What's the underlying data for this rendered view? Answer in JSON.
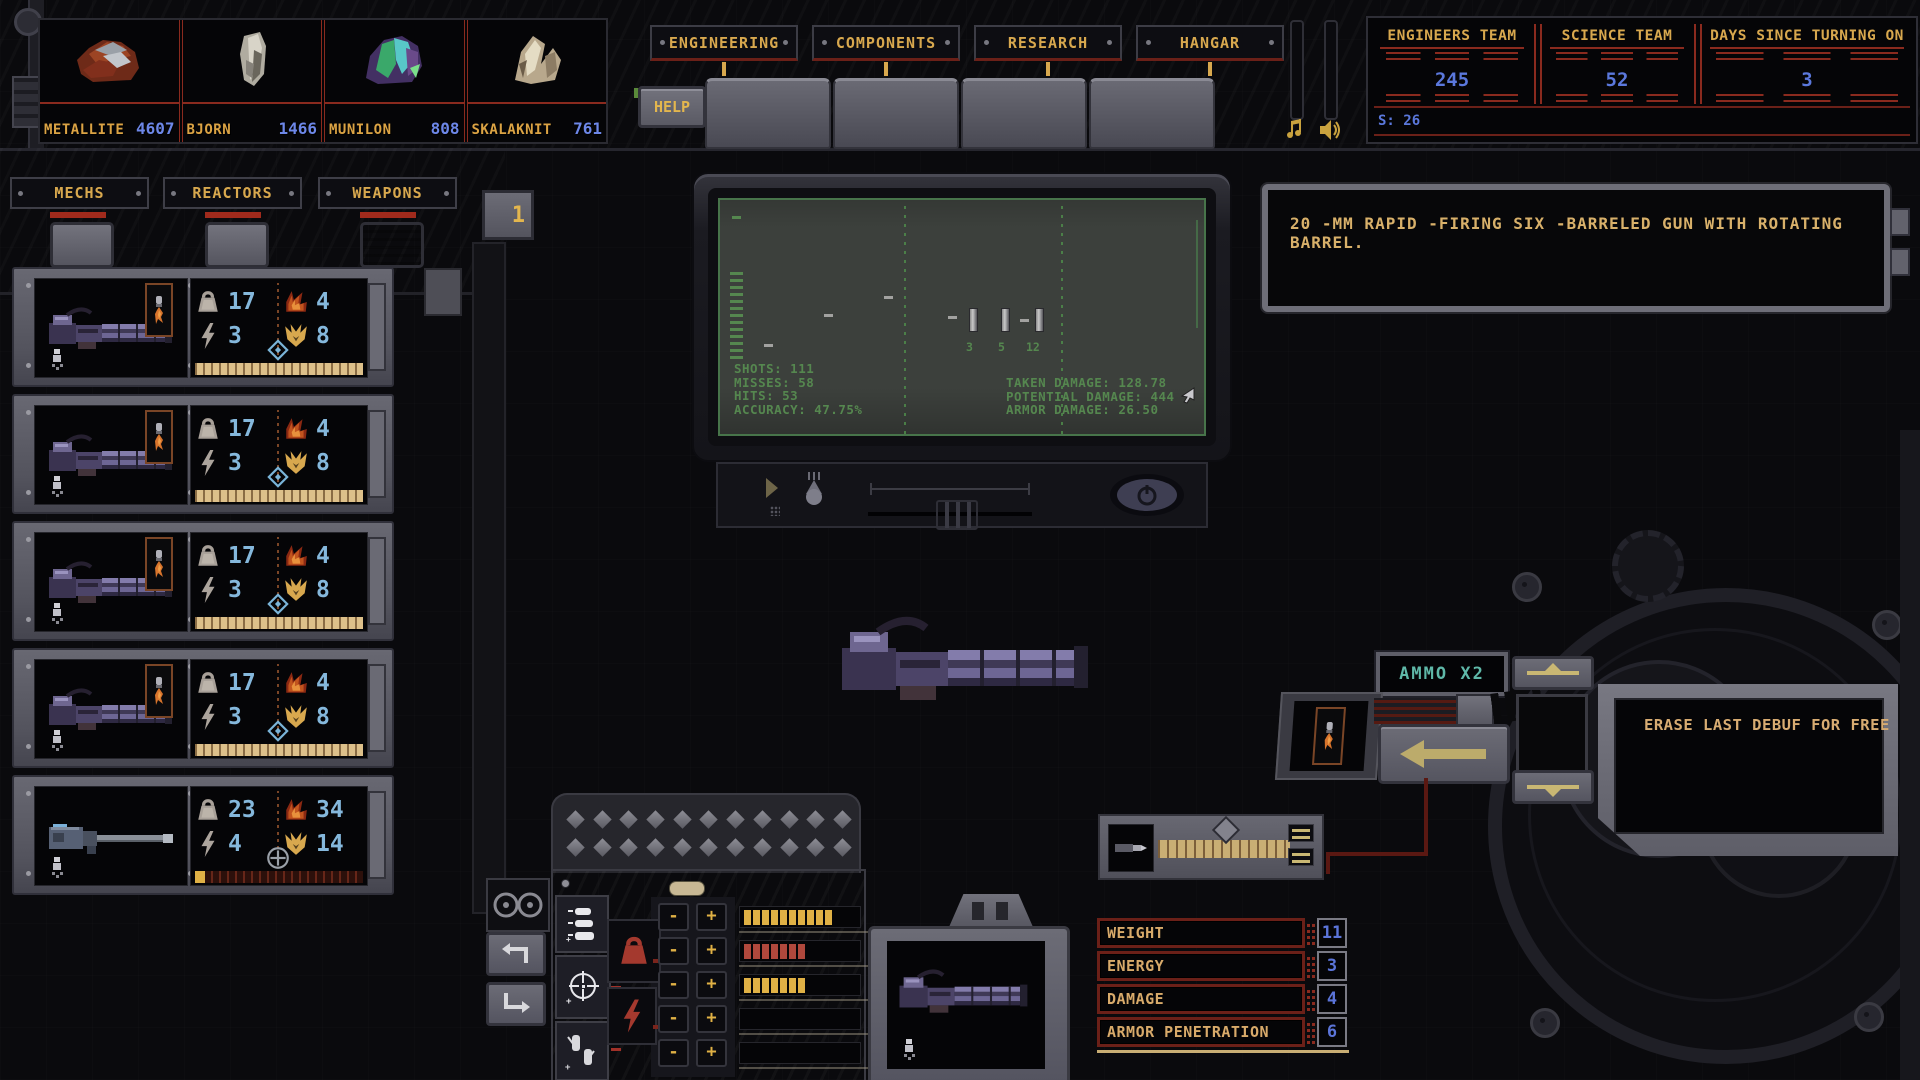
{
  "resources": {
    "items": [
      {
        "name": "METALLITE",
        "value": "4607"
      },
      {
        "name": "BJORN",
        "value": "1466"
      },
      {
        "name": "MUNILON",
        "value": "808"
      },
      {
        "name": "SKALAKNIT",
        "value": "761"
      }
    ]
  },
  "top_nav": {
    "tabs": [
      {
        "label": "ENGINEERING"
      },
      {
        "label": "COMPONENTS"
      },
      {
        "label": "RESEARCH"
      },
      {
        "label": "HANGAR"
      }
    ],
    "help_label": "HELP"
  },
  "status_board": {
    "engineers_label": "ENGINEERS TEAM",
    "engineers_value": "245",
    "science_label": "SCIENCE TEAM",
    "science_value": "52",
    "days_label": "DAYS SINCE TURNING ON",
    "days_value": "3",
    "s_counter": "S: 26"
  },
  "left_nav": {
    "tabs": [
      {
        "label": "MECHS"
      },
      {
        "label": "REACTORS"
      },
      {
        "label": "WEAPONS"
      }
    ],
    "page_indicator": "1"
  },
  "weapons": {
    "items": [
      {
        "sprite": "minigun",
        "target_icon": "diamond",
        "weight": "17",
        "energy": "3",
        "damage": "4",
        "armor_pen": "8",
        "durability_pct": 100
      },
      {
        "sprite": "minigun",
        "target_icon": "diamond",
        "weight": "17",
        "energy": "3",
        "damage": "4",
        "armor_pen": "8",
        "durability_pct": 100
      },
      {
        "sprite": "minigun",
        "target_icon": "diamond",
        "weight": "17",
        "energy": "3",
        "damage": "4",
        "armor_pen": "8",
        "durability_pct": 100
      },
      {
        "sprite": "minigun",
        "target_icon": "diamond",
        "weight": "17",
        "energy": "3",
        "damage": "4",
        "armor_pen": "8",
        "durability_pct": 100
      },
      {
        "sprite": "cannon",
        "target_icon": "plus",
        "weight": "23",
        "energy": "4",
        "damage": "34",
        "armor_pen": "14",
        "durability_pct": 6
      }
    ]
  },
  "crt": {
    "left_lines": [
      "SHOTS: 111",
      "MISSES: 58",
      "HITS: 53",
      "ACCURACY: 47.75%"
    ],
    "right_lines": [
      "TAKEN DAMAGE: 128.78",
      "POTENTIAL DAMAGE: 444",
      "ARMOR DAMAGE: 26.50"
    ],
    "target_counts": [
      "3",
      "5",
      "12"
    ]
  },
  "workshop": {
    "description": "20 -MM RAPID -FIRING SIX -BARRELED GUN WITH ROTATING BARREL.",
    "ammo_badge": "AMMO X2",
    "erase_offer": "ERASE LAST DEBUF FOR FREE"
  },
  "stat_table": {
    "rows": [
      {
        "label": "WEIGHT",
        "value": "11"
      },
      {
        "label": "ENERGY",
        "value": "3"
      },
      {
        "label": "DAMAGE",
        "value": "4"
      },
      {
        "label": "ARMOR PENETRATION",
        "value": "6"
      }
    ]
  },
  "upgrades": {
    "rows": [
      {
        "segments": 10,
        "color": "#e0b145"
      },
      {
        "segments": 7,
        "color": "#b0483c"
      },
      {
        "segments": 7,
        "color": "#e0b145"
      },
      {
        "segments": 0,
        "color": "#e0b145"
      },
      {
        "segments": 0,
        "color": "#e0b145"
      }
    ]
  },
  "ui": {
    "minus": "-",
    "plus": "+"
  },
  "colors": {
    "accent_gold": "#d8a84e",
    "value_blue": "#5b78dc",
    "stat_blue": "#85b8dc",
    "crt_green": "#55874f",
    "ammo_teal": "#5fb8a8",
    "alert_red": "#a02a1c"
  }
}
